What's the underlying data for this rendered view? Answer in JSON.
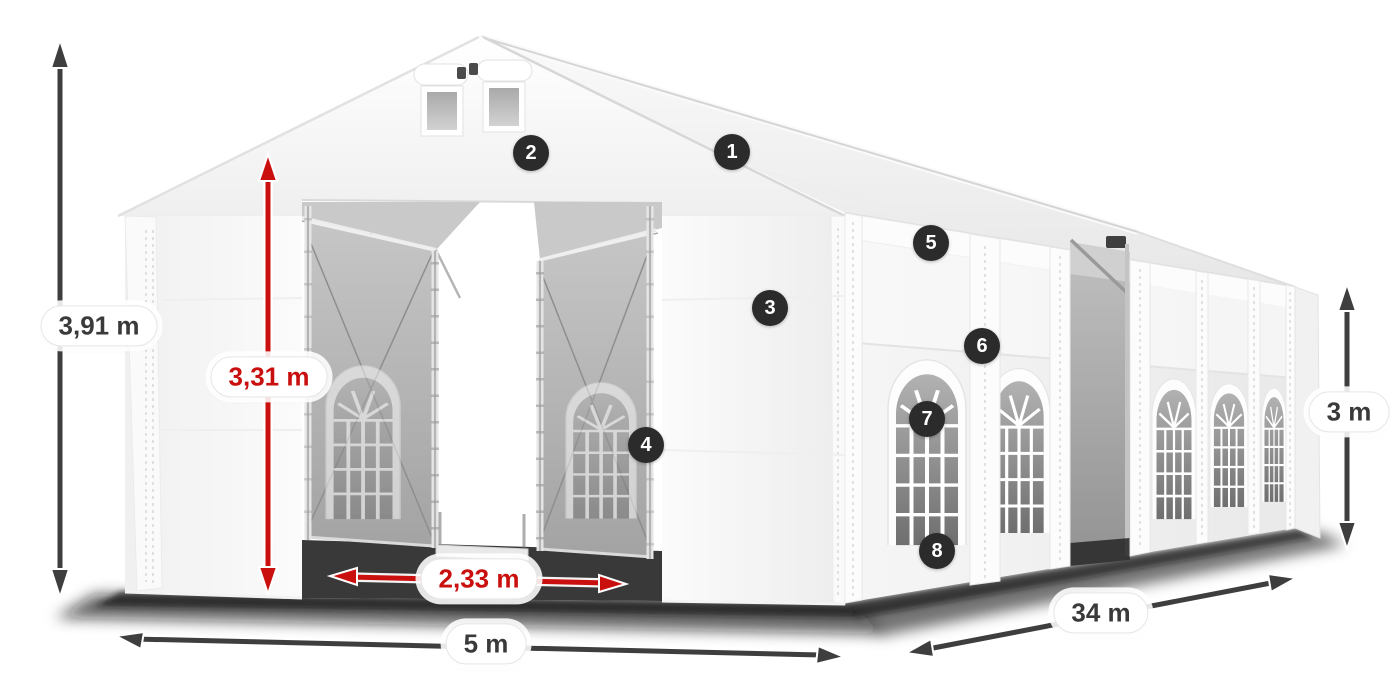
{
  "diagram": {
    "name": "marquee-tent-dimension-diagram",
    "background_color": "#ffffff",
    "colors": {
      "dimension_arrow_dark": "#3e3e3e",
      "dimension_arrow_red": "#c9100e",
      "label_background": "#ffffff",
      "label_text_dark": "#3a3a3a",
      "label_text_red": "#c9100e",
      "marker_background": "#2b2b2b",
      "marker_text": "#ffffff",
      "tent_fabric": "#f4f4f4",
      "window_glass": "#9d9d9d"
    },
    "dimensions": {
      "total_height": {
        "label": "3,91 m",
        "style": "dark"
      },
      "entrance_height": {
        "label": "3,31 m",
        "style": "red"
      },
      "entrance_width": {
        "label": "2,33 m",
        "style": "red"
      },
      "front_width": {
        "label": "5 m",
        "style": "dark"
      },
      "side_length": {
        "label": "34 m",
        "style": "dark"
      },
      "side_height": {
        "label": "3 m",
        "style": "dark"
      }
    },
    "markers": {
      "m1": "1",
      "m2": "2",
      "m3": "3",
      "m4": "4",
      "m5": "5",
      "m6": "6",
      "m7": "7",
      "m8": "8"
    }
  }
}
